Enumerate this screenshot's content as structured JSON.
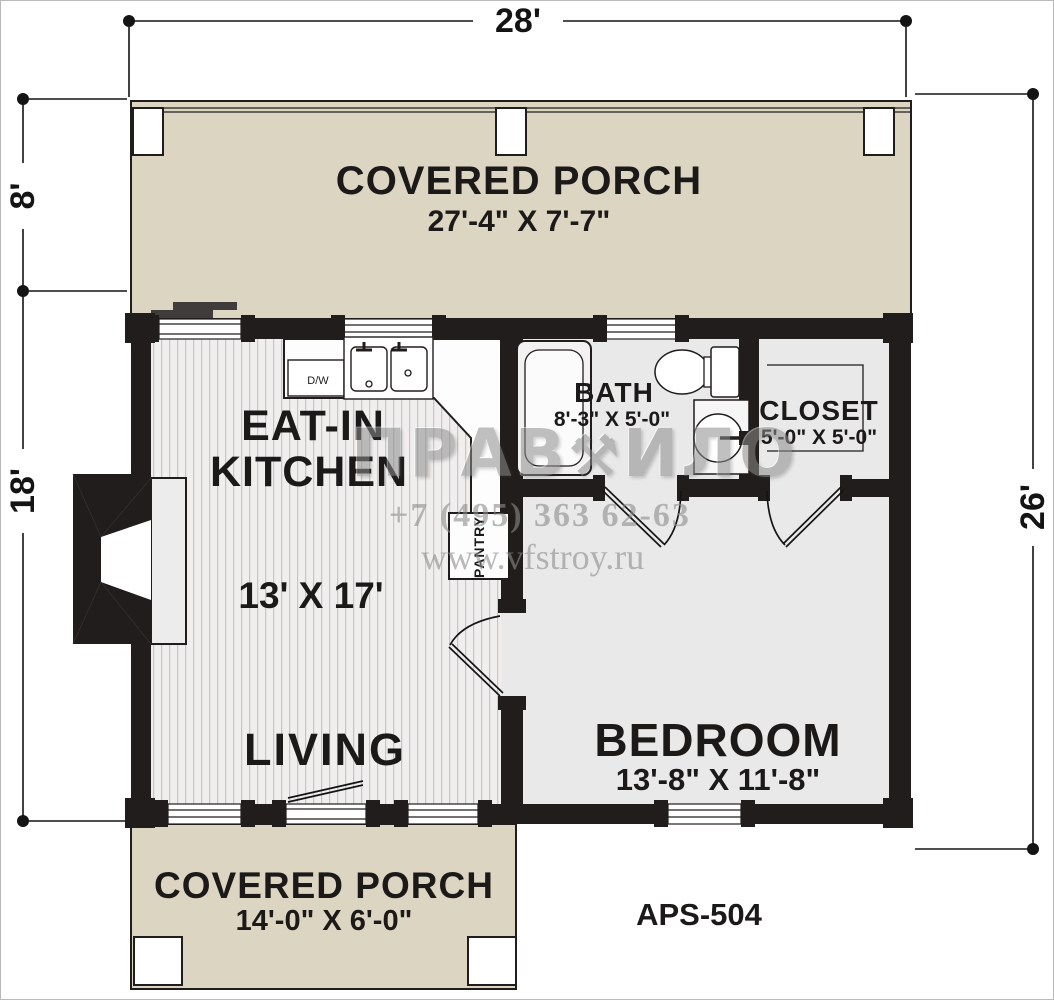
{
  "title_block": {
    "plan_number": "APS-504"
  },
  "dimensions": {
    "top": "28'",
    "left_upper": "8'",
    "left_lower": "18'",
    "right": "26'"
  },
  "rooms": {
    "porch_top": {
      "name": "COVERED PORCH",
      "size": "27'-4\" X 7'-7\""
    },
    "kitchen": {
      "line1": "EAT-IN",
      "line2": "KITCHEN",
      "size": "13' X 17'"
    },
    "bath": {
      "name": "BATH",
      "size": "8'-3\" X 5'-0\""
    },
    "closet": {
      "name": "CLOSET",
      "size": "5'-0\" X 5'-0\""
    },
    "living": {
      "name": "LIVING"
    },
    "bedroom": {
      "name": "BEDROOM",
      "size": "13'-8\" X 11'-8\""
    },
    "porch_bottom": {
      "name": "COVERED PORCH",
      "size": "14'-0\" X 6'-0\""
    }
  },
  "fixtures": {
    "dishwasher": "D/W",
    "pantry": "PANTRY"
  },
  "watermark": {
    "logo_left": "ПРАВ",
    "logo_wrench": "⚒",
    "logo_right": "ИЛО",
    "phone": "+7 (495) 363 62-63",
    "website": "www.vfstroy.ru"
  },
  "colors": {
    "wall": "#201d1c",
    "porch": "#dbd5c1",
    "room_fill": "#e9e9e9",
    "floor_stripe": "#c6c6c6"
  }
}
